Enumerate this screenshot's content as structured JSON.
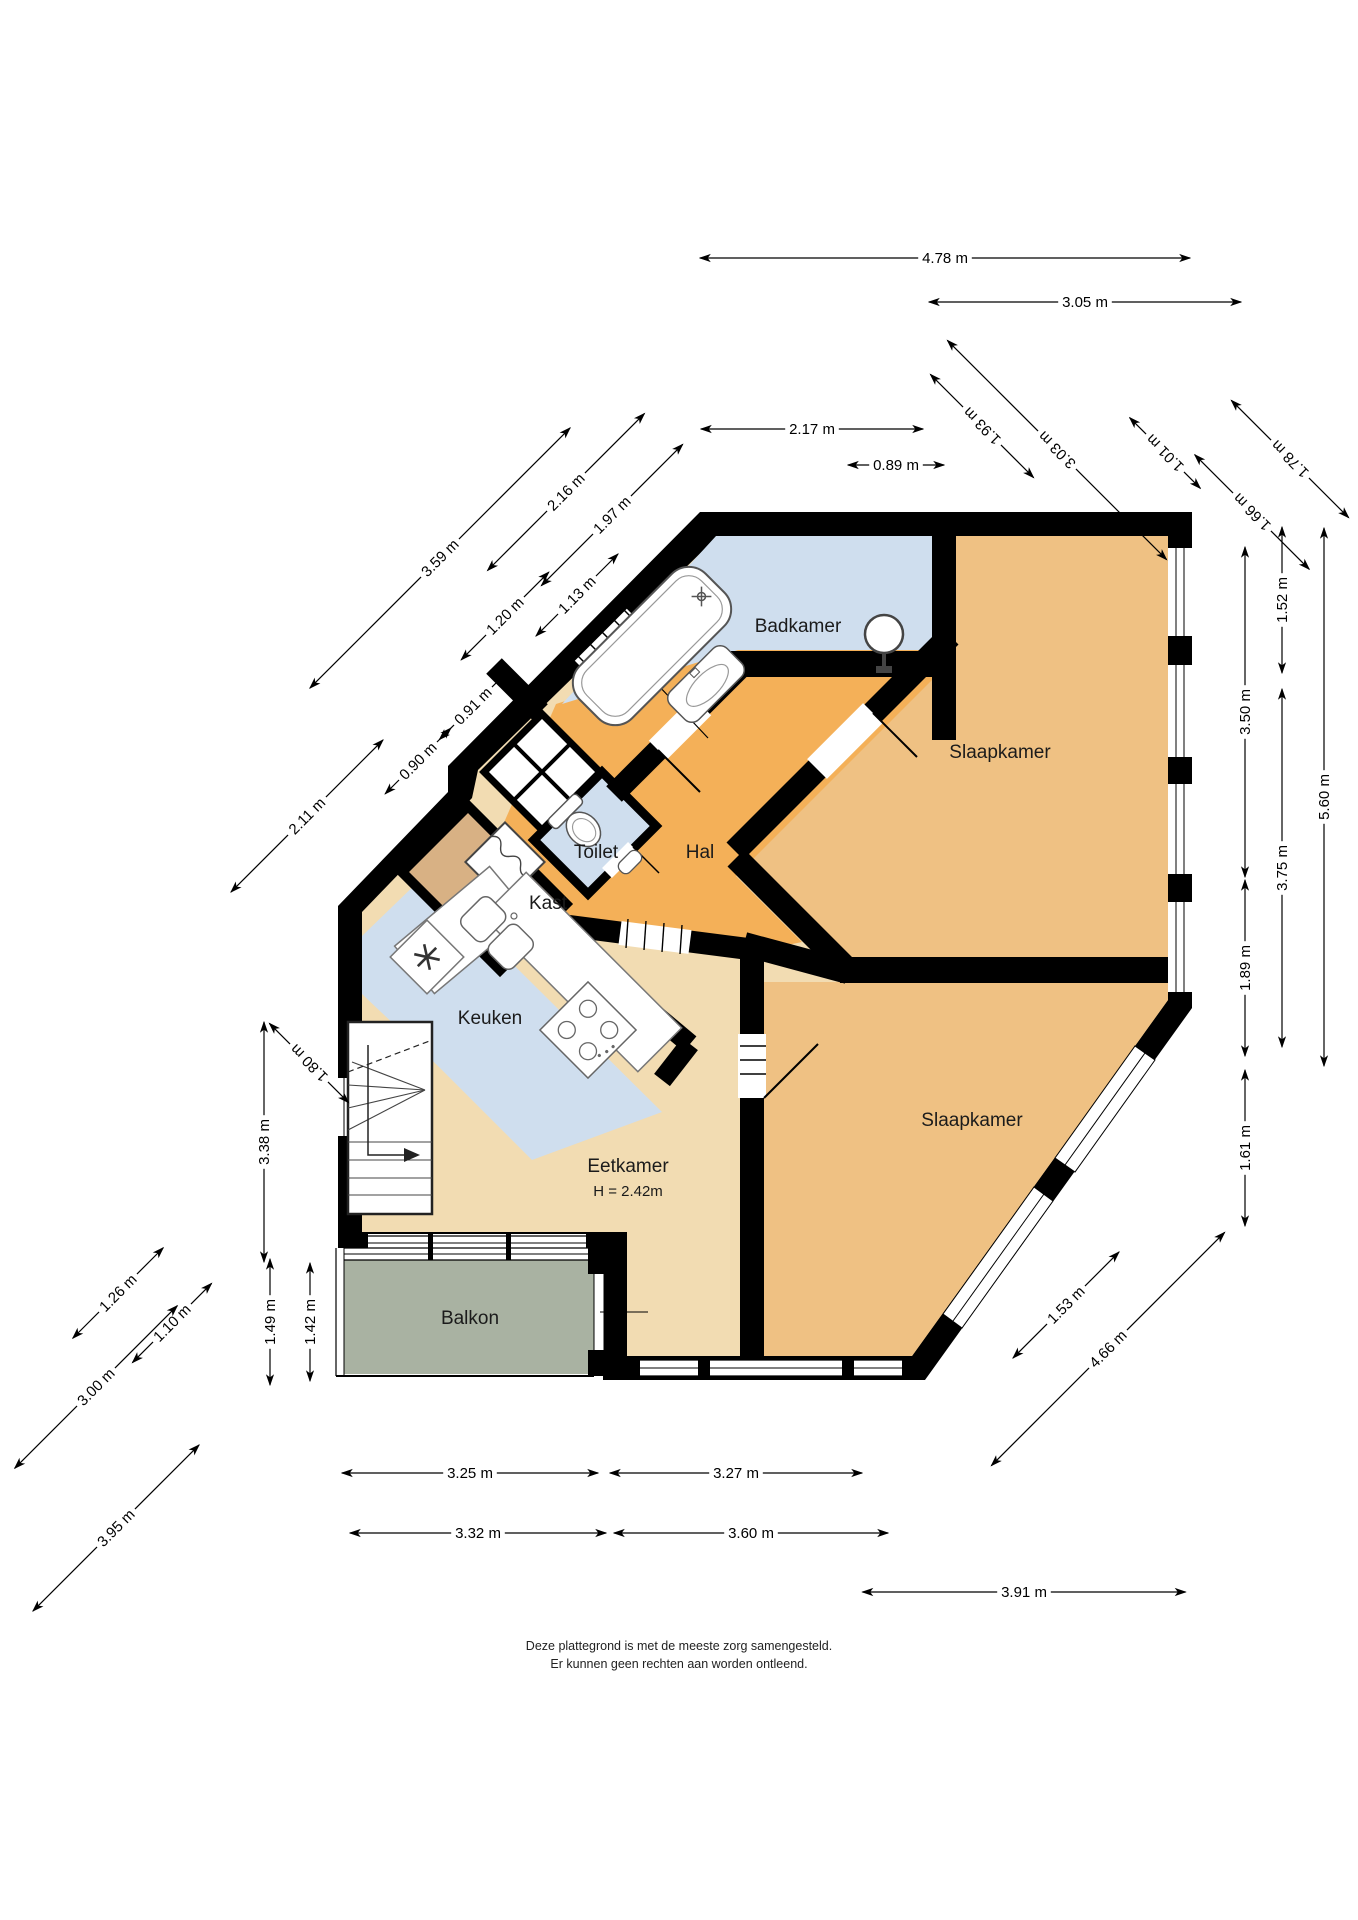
{
  "rooms": {
    "badkamer": {
      "label": "Badkamer"
    },
    "slaapkamer1": {
      "label": "Slaapkamer"
    },
    "hal": {
      "label": "Hal"
    },
    "toilet": {
      "label": "Toilet"
    },
    "kast": {
      "label": "Kast"
    },
    "keuken": {
      "label": "Keuken"
    },
    "eetkamer": {
      "label": "Eetkamer",
      "height_note": "H = 2.42m"
    },
    "slaapkamer2": {
      "label": "Slaapkamer"
    },
    "balkon": {
      "label": "Balkon"
    }
  },
  "footer": {
    "line1": "Deze plattegrond is met de meeste zorg samengesteld.",
    "line2": "Er kunnen geen rechten aan worden ontleend."
  },
  "colors": {
    "wall": "#000000",
    "wet_room_floor": "#cfdeee",
    "bedroom_floor": "#efc183",
    "hall_floor": "#f4b058",
    "dining_floor": "#f2dcb2",
    "closet_floor": "#d8b184",
    "balcony_floor": "#a9b2a2"
  },
  "dimensions": [
    {
      "label": "4.78 m",
      "x": 945,
      "y": 258,
      "a": 0,
      "len": 490
    },
    {
      "label": "3.05 m",
      "x": 1085,
      "y": 302,
      "a": 0,
      "len": 312
    },
    {
      "label": "2.17 m",
      "x": 812,
      "y": 429,
      "a": 0,
      "len": 222
    },
    {
      "label": "0.89 m",
      "x": 896,
      "y": 465,
      "a": 0,
      "len": 96
    },
    {
      "label": "1.93 m",
      "x": 982,
      "y": 426,
      "a": 45,
      "len": 146,
      "flip": true
    },
    {
      "label": "3.03 m",
      "x": 1057,
      "y": 450,
      "a": 45,
      "len": 310,
      "flip": true
    },
    {
      "label": "1.01 m",
      "x": 1165,
      "y": 453,
      "a": 45,
      "len": 100,
      "flip": true
    },
    {
      "label": "1.66 m",
      "x": 1252,
      "y": 512,
      "a": 45,
      "len": 162,
      "flip": true
    },
    {
      "label": "1.78 m",
      "x": 1290,
      "y": 459,
      "a": 45,
      "len": 166,
      "flip": true
    },
    {
      "label": "2.16 m",
      "x": 566,
      "y": 492,
      "a": -45,
      "len": 222
    },
    {
      "label": "1.97 m",
      "x": 612,
      "y": 515,
      "a": -45,
      "len": 200
    },
    {
      "label": "3.59 m",
      "x": 440,
      "y": 558,
      "a": -45,
      "len": 368
    },
    {
      "label": "1.20 m",
      "x": 505,
      "y": 616,
      "a": -45,
      "len": 124
    },
    {
      "label": "1.13 m",
      "x": 577,
      "y": 595,
      "a": -45,
      "len": 116
    },
    {
      "label": "0.91 m",
      "x": 473,
      "y": 706,
      "a": -45,
      "len": 95
    },
    {
      "label": "0.90 m",
      "x": 418,
      "y": 761,
      "a": -45,
      "len": 93
    },
    {
      "label": "2.11 m",
      "x": 307,
      "y": 816,
      "a": -45,
      "len": 215
    },
    {
      "label": "1.52 m",
      "x": 1282,
      "y": 600,
      "a": -90,
      "len": 146
    },
    {
      "label": "3.50 m",
      "x": 1245,
      "y": 712,
      "a": -90,
      "len": 330
    },
    {
      "label": "3.75 m",
      "x": 1282,
      "y": 868,
      "a": -90,
      "len": 358
    },
    {
      "label": "1.89 m",
      "x": 1245,
      "y": 968,
      "a": -90,
      "len": 176
    },
    {
      "label": "1.61 m",
      "x": 1245,
      "y": 1148,
      "a": -90,
      "len": 156
    },
    {
      "label": "5.60 m",
      "x": 1324,
      "y": 797,
      "a": -90,
      "len": 538
    },
    {
      "label": "3.38 m",
      "x": 264,
      "y": 1142,
      "a": -90,
      "len": 240
    },
    {
      "label": "1.80 m",
      "x": 309,
      "y": 1063,
      "a": 45,
      "len": 112,
      "flip": true
    },
    {
      "label": "1.49 m",
      "x": 270,
      "y": 1322,
      "a": -90,
      "len": 126
    },
    {
      "label": "1.42 m",
      "x": 310,
      "y": 1322,
      "a": -90,
      "len": 118
    },
    {
      "label": "1.26 m",
      "x": 118,
      "y": 1293,
      "a": -45,
      "len": 128
    },
    {
      "label": "1.10 m",
      "x": 172,
      "y": 1323,
      "a": -45,
      "len": 112
    },
    {
      "label": "3.00 m",
      "x": 96,
      "y": 1387,
      "a": -45,
      "len": 230
    },
    {
      "label": "3.95 m",
      "x": 116,
      "y": 1528,
      "a": -45,
      "len": 235
    },
    {
      "label": "3.25 m",
      "x": 470,
      "y": 1473,
      "a": 0,
      "len": 256
    },
    {
      "label": "3.27 m",
      "x": 736,
      "y": 1473,
      "a": 0,
      "len": 252
    },
    {
      "label": "3.32 m",
      "x": 478,
      "y": 1533,
      "a": 0,
      "len": 256
    },
    {
      "label": "3.60 m",
      "x": 751,
      "y": 1533,
      "a": 0,
      "len": 274
    },
    {
      "label": "3.91 m",
      "x": 1024,
      "y": 1592,
      "a": 0,
      "len": 323
    },
    {
      "label": "1.53 m",
      "x": 1066,
      "y": 1305,
      "a": -45,
      "len": 150
    },
    {
      "label": "4.66 m",
      "x": 1108,
      "y": 1349,
      "a": -45,
      "len": 330
    }
  ]
}
